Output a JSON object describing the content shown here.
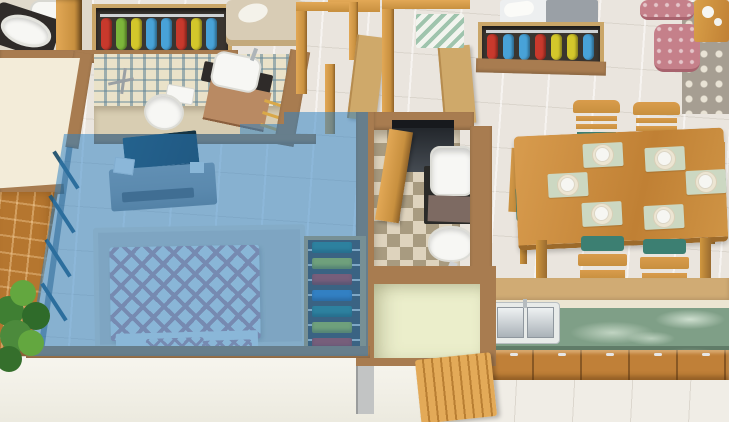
{
  "meta": {
    "title": "3D isometric apartment floor plan with highlighted master bedroom",
    "view": "isometric top-down render",
    "visible_text": "none"
  },
  "highlight": {
    "room": "master-bedroom",
    "overlay_color": "rgba(45,128,196,0.52)",
    "state": "selected"
  },
  "rooms": [
    {
      "id": "master-bedroom",
      "name": "Master Bedroom",
      "highlighted": true,
      "objects": [
        "double bed with pink diamond-pattern duvet",
        "wall-mounted TV",
        "gray floating TV console",
        "open wardrobe with folded clothes",
        "beige area rug",
        "window wall"
      ]
    },
    {
      "id": "ensuite-bathroom",
      "name": "En-suite Bathroom",
      "objects": [
        "toilet",
        "vessel sink on wooden vanity",
        "shower mixer",
        "blue patterned tile wall",
        "golden towel rail"
      ]
    },
    {
      "id": "corner-bathroom",
      "name": "Corner Bathroom",
      "objects": [
        "oval countertop basin",
        "toilet",
        "wooden door"
      ]
    },
    {
      "id": "common-bathroom",
      "name": "Common Bathroom",
      "objects": [
        "square wash basin",
        "toilet",
        "checkered tile floor",
        "dark feature wall",
        "wooden door"
      ]
    },
    {
      "id": "hallway",
      "name": "Hallway",
      "objects": [
        "wooden door frames",
        "two wooden doors",
        "chevron runner rug"
      ]
    },
    {
      "id": "living-area",
      "name": "Living Area",
      "objects": [
        "daybed with gray throw",
        "open wardrobe with hanging clothes",
        "two pink tufted poufs",
        "gray trellis-pattern rug",
        "wooden coffee table with white tea set"
      ]
    },
    {
      "id": "dining-area",
      "name": "Dining Area",
      "objects": [
        "six-seater wooden dining table",
        "six wooden chairs with teal cushions",
        "six place settings on sage placemats"
      ]
    },
    {
      "id": "kitchen",
      "name": "Kitchen",
      "objects": [
        "green marble countertop",
        "double stainless-steel sink",
        "wooden base cabinets with handles"
      ]
    },
    {
      "id": "utility-room",
      "name": "Utility Room",
      "objects": [
        "pale green walls",
        "open slatted wooden door",
        "gray appliance"
      ]
    },
    {
      "id": "balcony",
      "name": "Balcony",
      "objects": [
        "terracotta tile floor",
        "green potted plant",
        "cream wall"
      ]
    }
  ],
  "wardrobes": {
    "hall": {
      "garments": [
        "#c8392c",
        "#7cb53a",
        "#d3c72b",
        "#48a2d8",
        "#48a2d8",
        "#c8392c",
        "#d3c72b",
        "#48a2d8"
      ]
    },
    "living": {
      "garments": [
        "#c8392c",
        "#48a2d8",
        "#48a2d8",
        "#c8392c",
        "#d3c72b",
        "#d3c72b",
        "#48a2d8"
      ]
    },
    "bedroom": {
      "stacks": [
        "#2f8378",
        "#b8c22e",
        "#c8392c",
        "#3a7fc2",
        "#2f8378",
        "#b8c22e",
        "#c8392c"
      ]
    }
  },
  "dining": {
    "seats": 6,
    "place_settings": 6,
    "placemat_color": "#ccd8c2",
    "cushion_color": "#3c7f72"
  },
  "palette": {
    "floor-tile": "#eae5de",
    "wall-brown": "#a87c50",
    "wall-brown-dark": "#8a6238",
    "terracotta": "#b5762f",
    "cream-wall": "#f3ecd9",
    "exterior-white": "#f6f4ec",
    "wood-light": "#e2a856",
    "wood-mid": "#c8903f",
    "wood-dark": "#8f6228",
    "door-tan": "#cfa96a",
    "dark-counter": "#2f2b29",
    "porcelain": "#f7f7f4",
    "tile-wall-bg": "#eae2c9",
    "tile-wall-pattern": "#5d8296",
    "bath-floor": "#d8cdb2",
    "checker-a": "#ded3bd",
    "checker-b": "#a89b80",
    "dark-wall": "#3a3f45",
    "vanity-wood": "#b98a63",
    "tv-dark": "#142f3d",
    "console-gray": "#8e9397",
    "rug-beige": "#d7cec0",
    "bed-white": "#eef0ec",
    "bed-pink": "#c7959e",
    "marble-green": "#7f9f87",
    "cabinet-wood": "#c08038",
    "placemat": "#ccd8c2",
    "plate-white": "#f6f6f2",
    "chair-teal": "#3c7f72",
    "pouf-pink": "#c5808a",
    "rug-gray": "#a69e92",
    "rug-gray-pattern": "#e9e3d5",
    "chevron-green": "#9fc4ad",
    "utility-green": "#ebeecb",
    "plant-green": "#4c8a3c",
    "sheet-gray": "#9aa0a6"
  }
}
